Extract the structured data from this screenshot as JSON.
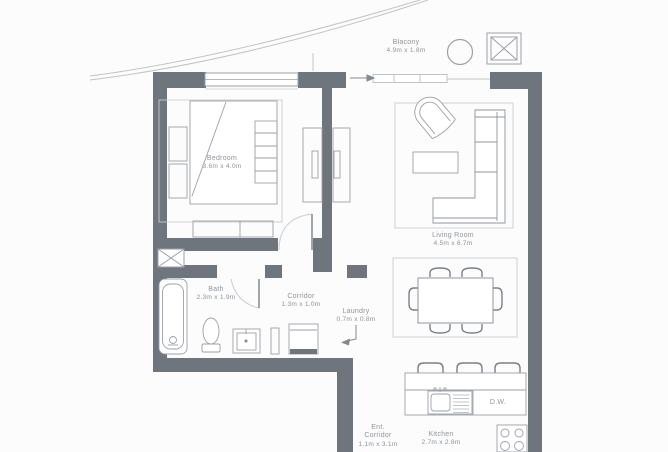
{
  "plan": {
    "rooms": [
      {
        "name": "Blacony",
        "dims": "4.9m x 1.8m"
      },
      {
        "name": "Bedroom",
        "dims": "3.6m x 4.0m"
      },
      {
        "name": "Living Room",
        "dims": "4.5m x 6.7m"
      },
      {
        "name": "Bath",
        "dims": "2.3m x 1.9m"
      },
      {
        "name": "Corridor",
        "dims": "1.3m x 1.0m"
      },
      {
        "name": "Laundry",
        "dims": "0.7m x 0.8m"
      },
      {
        "name": "Ent. Corridor",
        "dims": "1.1m x 3.1m"
      },
      {
        "name": "Kitchen",
        "dims": "2.7m x 2.8m"
      }
    ],
    "labels": {
      "dishwasher": "D.W."
    },
    "colors": {
      "wall": "#6e757c",
      "furniture_line": "#9ba1a7",
      "dark_line": "#7b828a",
      "light_line": "#c9cdd0",
      "text": "#8e959b",
      "background": "#fcfcfc"
    }
  }
}
